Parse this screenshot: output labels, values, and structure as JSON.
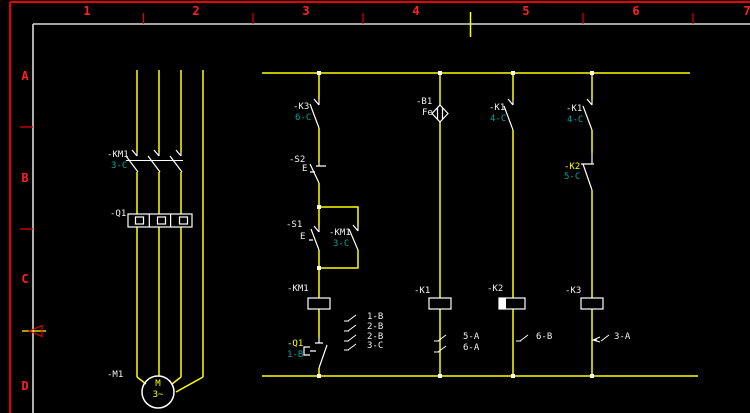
{
  "frame": {
    "columns": [
      "1",
      "2",
      "3",
      "4",
      "5",
      "6",
      "7"
    ],
    "rows": [
      "A",
      "B",
      "C",
      "D"
    ]
  },
  "labels": {
    "km1_main": "-KM1",
    "km1_main_xref": "3-C",
    "q1_main": "-Q1",
    "m1": "-M1",
    "motor_letter": "M",
    "motor_phases": "3~",
    "k3_contact": "-K3",
    "k3_contact_xref": "6-C",
    "s2": "-S2",
    "s2_actuator": "E",
    "s1": "-S1",
    "s1_actuator": "E",
    "km1_aux": "-KM1",
    "km1_aux_xref": "3-C",
    "km1_coil": "-KM1",
    "q1_aux": "-Q1",
    "q1_aux_xref": "1-B",
    "km1_xrefs": [
      "1-B",
      "2-B",
      "2-B",
      "3-C"
    ],
    "b1": "-B1",
    "b1_material": "Fe",
    "k1_coil": "-K1",
    "k1_xrefs": [
      "5-A",
      "6-A"
    ],
    "k1_contact_3": "-K1",
    "k1_contact_3_xref": "4-C",
    "k2_coil": "-K2",
    "k2_xrefs": [
      "6-B"
    ],
    "k1_contact_4": "-K1",
    "k1_contact_4_xref": "4-C",
    "k2_contact": "-K2",
    "k2_contact_xref": "5-C",
    "k3_coil": "-K3",
    "k3_xrefs": [
      "3-A"
    ]
  },
  "colors": {
    "background": "#000000",
    "wire": "#ffff00",
    "symbol": "#ffffff",
    "xref_text": "#00a6a6",
    "frame_red": "#e60000",
    "inner_border": "#d9d9d9",
    "highlight": "#ffff00"
  }
}
